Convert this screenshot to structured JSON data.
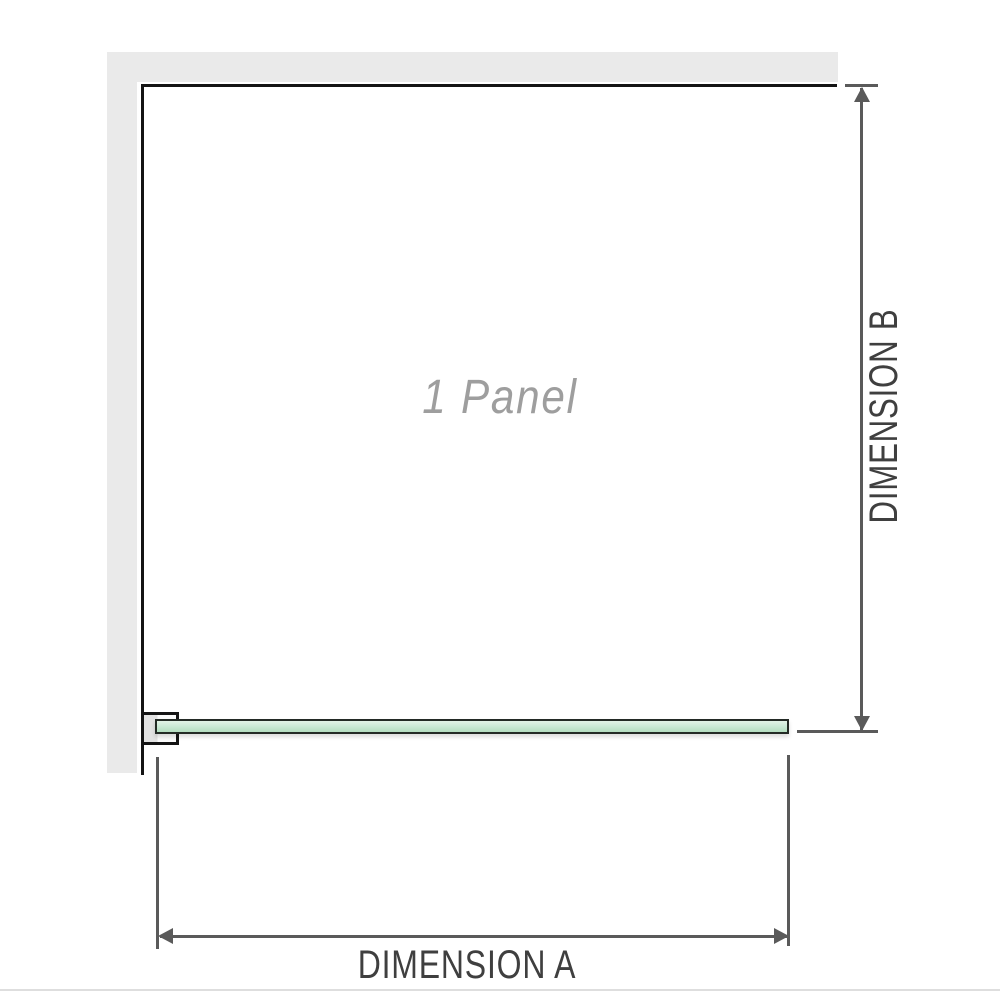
{
  "diagram": {
    "panel_label": "1 Panel",
    "dimension_a": {
      "label": "DIMENSION A"
    },
    "dimension_b": {
      "label": "DIMENSION B"
    }
  },
  "icons": {
    "dim_b_start": "arrow-up",
    "dim_b_end": "arrow-down",
    "dim_a_start": "arrow-left",
    "dim_a_end": "arrow-right"
  },
  "colors": {
    "background": "#ffffff",
    "wall_fill": "#eaeaea",
    "outline": "#141414",
    "dimension": "#5a5a5a",
    "label_text": "#3f3f3f",
    "panel_text": "#9e9e9e",
    "glass_border": "#232a25",
    "glass_top": "#e3f2e7",
    "glass_mid": "#cdead7",
    "glass_bottom": "#b3ddbf",
    "bracket_fill": "#e2e2e2",
    "bracket_face": "#fbfbfb",
    "footer_line": "#dedede"
  }
}
